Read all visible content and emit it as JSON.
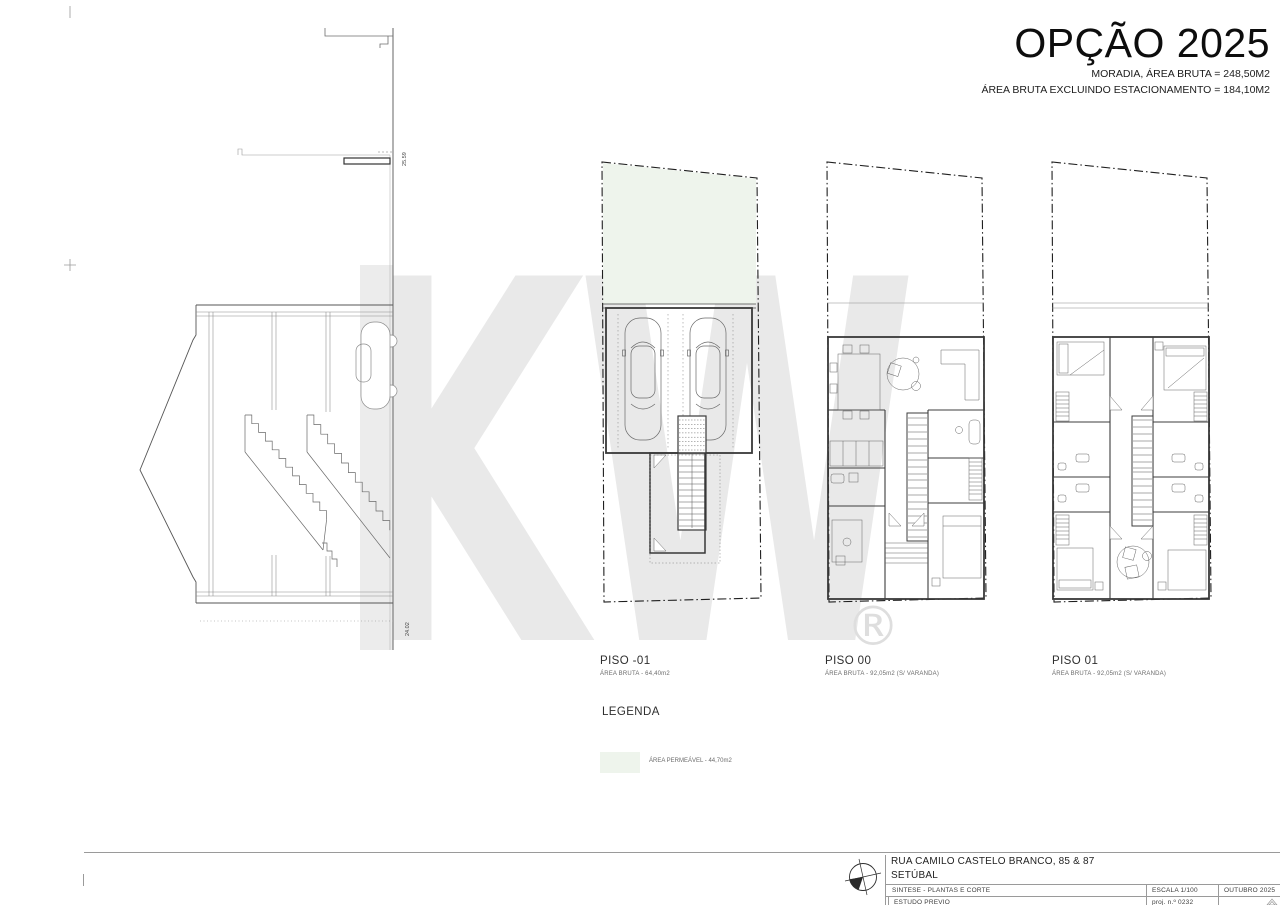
{
  "header": {
    "title": "OPÇÃO 2025",
    "subtitle1": "MORADIA, ÁREA BRUTA = 248,50M2",
    "subtitle2": "ÁREA BRUTA EXCLUINDO ESTACIONAMENTO = 184,10M2"
  },
  "watermark": {
    "text": "KW",
    "registered": "®",
    "color": "#e9e9e9"
  },
  "section": {
    "dim_upper": "25.59",
    "dim_lower": "24.02"
  },
  "plans": [
    {
      "label": "PISO -01",
      "area": "ÁREA BRUTA - 64,40m2"
    },
    {
      "label": "PISO 00",
      "area": "ÁREA BRUTA - 92,05m2 (S/ VARANDA)"
    },
    {
      "label": "PISO 01",
      "area": "ÁREA BRUTA - 92,05m2 (S/ VARANDA)"
    }
  ],
  "legend": {
    "heading": "LEGENDA",
    "items": [
      {
        "label": "ÁREA PERMEÁVEL - 44,70m2",
        "color": "#eef4ec"
      }
    ]
  },
  "title_block": {
    "address": "RUA CAMILO CASTELO BRANCO, 85 & 87",
    "city": "SETÚBAL",
    "subject": "SINTESE - PLANTAS E CORTE",
    "phase": "ESTUDO PREVIO",
    "scale": "ESCALA 1/100",
    "date": "OUTUBRO 2025",
    "project_no": "proj. n.º 0232"
  }
}
